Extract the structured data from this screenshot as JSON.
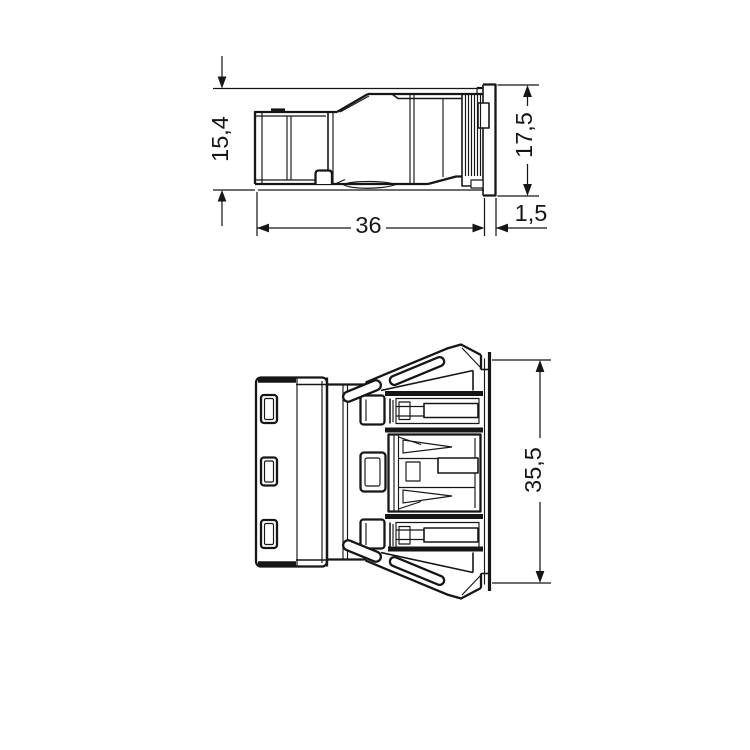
{
  "colors": {
    "background": "#ffffff",
    "line": "#161616"
  },
  "views": {
    "side_view": {
      "dimensions": {
        "plug_height": "15,4",
        "panel_height": "17,5",
        "housing_length": "36",
        "panel_thickness": "1,5"
      }
    },
    "top_view": {
      "dimensions": {
        "housing_width": "35,5"
      }
    }
  }
}
